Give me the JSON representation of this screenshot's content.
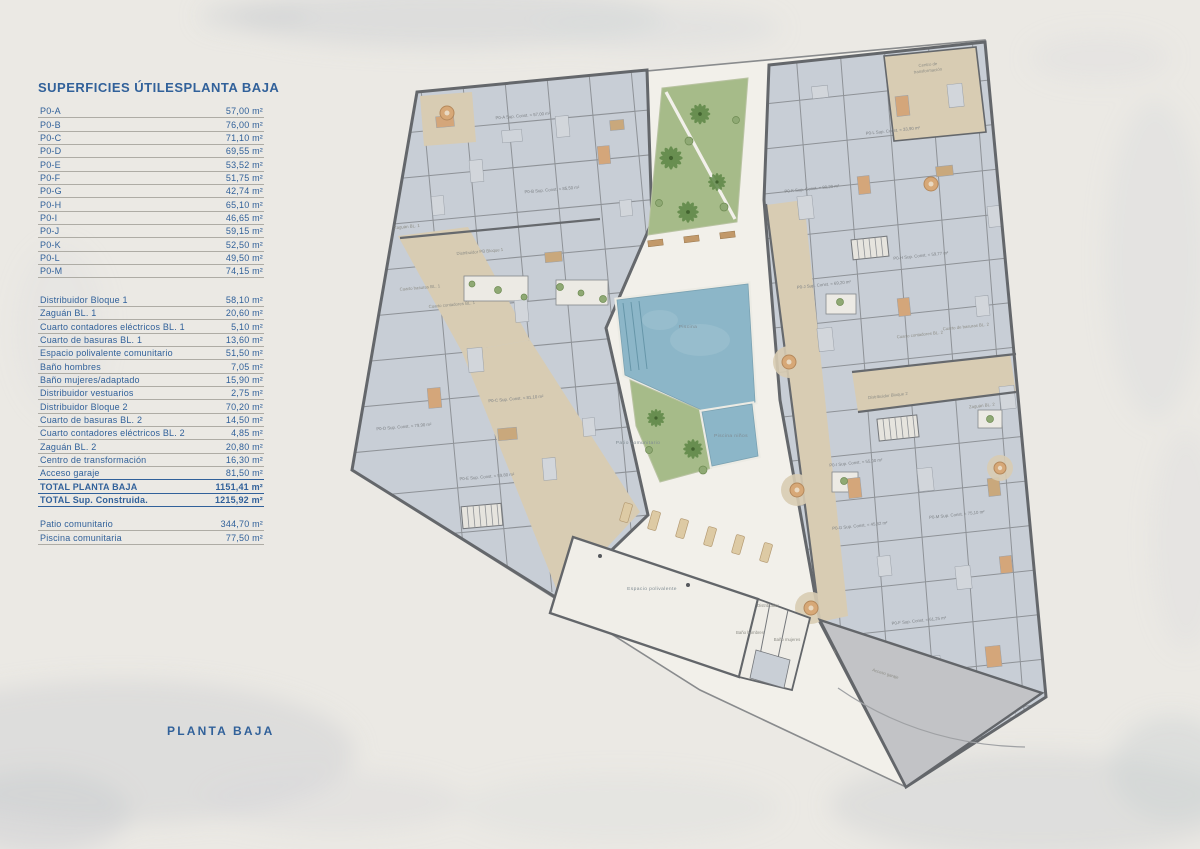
{
  "panel": {
    "title": "SUPERFICIES ÚTILES",
    "subtitle": "PLANTA BAJA",
    "sections": [
      {
        "rows": [
          {
            "label": "P0-A",
            "value": "57,00 m²"
          },
          {
            "label": "P0-B",
            "value": "76,00 m²"
          },
          {
            "label": "P0-C",
            "value": "71,10 m²"
          },
          {
            "label": "P0-D",
            "value": "69,55 m²"
          },
          {
            "label": "P0-E",
            "value": "53,52 m²"
          },
          {
            "label": "P0-F",
            "value": "51,75 m²"
          },
          {
            "label": "P0-G",
            "value": "42,74 m²"
          },
          {
            "label": "P0-H",
            "value": "65,10 m²"
          },
          {
            "label": "P0-I",
            "value": "46,65 m²"
          },
          {
            "label": "P0-J",
            "value": "59,15 m²"
          },
          {
            "label": "P0-K",
            "value": "52,50 m²"
          },
          {
            "label": "P0-L",
            "value": "49,50 m²"
          },
          {
            "label": "P0-M",
            "value": "74,15 m²"
          }
        ]
      },
      {
        "rows": [
          {
            "label": "Distribuidor Bloque 1",
            "value": "58,10 m²"
          },
          {
            "label": "Zaguán BL. 1",
            "value": "20,60 m²"
          },
          {
            "label": "Cuarto contadores eléctricos BL. 1",
            "value": "5,10 m²"
          },
          {
            "label": "Cuarto de basuras BL. 1",
            "value": "13,60 m²"
          },
          {
            "label": "Espacio polivalente comunitario",
            "value": "51,50 m²"
          },
          {
            "label": "Baño hombres",
            "value": "7,05 m²"
          },
          {
            "label": "Baño mujeres/adaptado",
            "value": "15,90 m²"
          },
          {
            "label": "Distribuidor vestuarios",
            "value": "2,75 m²"
          },
          {
            "label": "Distribuidor Bloque 2",
            "value": "70,20 m²"
          },
          {
            "label": "Cuarto de basuras BL. 2",
            "value": "14,50 m²"
          },
          {
            "label": "Cuarto contadores eléctricos BL. 2",
            "value": "4,85 m²"
          },
          {
            "label": "Zaguán BL. 2",
            "value": "20,80 m²"
          },
          {
            "label": "Centro de transformación",
            "value": "16,30 m²"
          },
          {
            "label": "Acceso garaje",
            "value": "81,50 m²"
          },
          {
            "label": "TOTAL PLANTA BAJA",
            "value": "1151,41 m²",
            "total": true
          },
          {
            "label": "TOTAL Sup. Construida.",
            "value": "1215,92 m²",
            "total": true
          }
        ]
      },
      {
        "rows": [
          {
            "label": "Patio comunitario",
            "value": "344,70 m²"
          },
          {
            "label": "Piscina comunitaria",
            "value": "77,50 m²"
          }
        ]
      }
    ]
  },
  "footer": {
    "label": "PLANTA BAJA"
  },
  "plan": {
    "colors": {
      "accent_navy": "#31619a",
      "wall": "#64676b",
      "apartment_floor": "#c8ced6",
      "corridor_tan": "#d8ccb3",
      "patio_white": "#f2f0ea",
      "pool_blue": "#8cb6c8",
      "garden_green": "#a6bb89",
      "ramp_gray": "#c2c3c6",
      "terracotta": "#d4a67a"
    },
    "labels": [
      {
        "text": "P0-A Sup. Const. = 57,00 m²",
        "x": 523,
        "y": 117,
        "r": -5,
        "k": "apt"
      },
      {
        "text": "P0-B Sup. Const. = 85,50 m²",
        "x": 552,
        "y": 191,
        "r": -5,
        "k": "apt"
      },
      {
        "text": "P0-C Sup. Const. = 81,10 m²",
        "x": 516,
        "y": 400,
        "r": -5,
        "k": "apt"
      },
      {
        "text": "P0-D Sup. Const. = 79,90 m²",
        "x": 404,
        "y": 428,
        "r": -5,
        "k": "apt"
      },
      {
        "text": "P0-E Sup. Const. = 59,80 m²",
        "x": 487,
        "y": 478,
        "r": -5,
        "k": "apt"
      },
      {
        "text": "P0-F Sup. Const. = 61,25 m²",
        "x": 919,
        "y": 622,
        "r": -6,
        "k": "apt"
      },
      {
        "text": "P0-G Sup. Const. = 45,82 m²",
        "x": 860,
        "y": 527,
        "r": -6,
        "k": "apt"
      },
      {
        "text": "P0-H Sup. Const. = 59,77 m²",
        "x": 921,
        "y": 257,
        "r": -6,
        "k": "apt"
      },
      {
        "text": "P0-I Sup. Const. = 55,00 m²",
        "x": 856,
        "y": 464,
        "r": -6,
        "k": "apt"
      },
      {
        "text": "P0-J Sup. Const. = 69,20 m²",
        "x": 824,
        "y": 286,
        "r": -6,
        "k": "apt"
      },
      {
        "text": "P0-K Sup. Const. = 80,20 m²",
        "x": 812,
        "y": 190,
        "r": -6,
        "k": "apt"
      },
      {
        "text": "P0-L Sup. Const. = 33,90 m²",
        "x": 893,
        "y": 132,
        "r": -6,
        "k": "apt"
      },
      {
        "text": "P0-M Sup. Const. = 75,10 m²",
        "x": 957,
        "y": 516,
        "r": -6,
        "k": "apt"
      },
      {
        "text": "Centro de",
        "x": 928,
        "y": 66,
        "r": -6,
        "k": "room"
      },
      {
        "text": "transformación",
        "x": 928,
        "y": 72,
        "r": -6,
        "k": "room"
      },
      {
        "text": "Zaguán BL. 1",
        "x": 407,
        "y": 228,
        "r": -5,
        "k": "room"
      },
      {
        "text": "Distribuidor PB Bloque 1",
        "x": 480,
        "y": 253,
        "r": -5,
        "k": "room"
      },
      {
        "text": "Cuarto basuras BL. 1",
        "x": 420,
        "y": 289,
        "r": -5,
        "k": "room"
      },
      {
        "text": "Cuarto contadores BL. 1",
        "x": 452,
        "y": 306,
        "r": -5,
        "k": "room"
      },
      {
        "text": "Cuarto de basuras BL. 2",
        "x": 966,
        "y": 328,
        "r": -6,
        "k": "room"
      },
      {
        "text": "Cuarto contadores BL. 2",
        "x": 920,
        "y": 336,
        "r": -6,
        "k": "room"
      },
      {
        "text": "Distribuidor Bloque 2",
        "x": 888,
        "y": 397,
        "r": -6,
        "k": "room"
      },
      {
        "text": "Zaguán BL. 2",
        "x": 982,
        "y": 407,
        "r": -6,
        "k": "room"
      },
      {
        "text": "Distribuidor",
        "x": 768,
        "y": 607,
        "r": 0,
        "k": "room"
      },
      {
        "text": "Baño hombres",
        "x": 750,
        "y": 634,
        "r": 0,
        "k": "room"
      },
      {
        "text": "Baño mujeres",
        "x": 787,
        "y": 641,
        "r": 0,
        "k": "room"
      },
      {
        "text": "Acceso garaje",
        "x": 885,
        "y": 675,
        "r": 17,
        "k": "room"
      },
      {
        "text": "Patio comunitario",
        "x": 638,
        "y": 444,
        "r": 0,
        "k": "zone"
      },
      {
        "text": "Piscina",
        "x": 688,
        "y": 328,
        "r": 0,
        "k": "zone"
      },
      {
        "text": "Piscina niños",
        "x": 731,
        "y": 437,
        "r": 0,
        "k": "zone"
      },
      {
        "text": "Espacio polivalente",
        "x": 652,
        "y": 590,
        "r": 0,
        "k": "zone"
      }
    ]
  }
}
